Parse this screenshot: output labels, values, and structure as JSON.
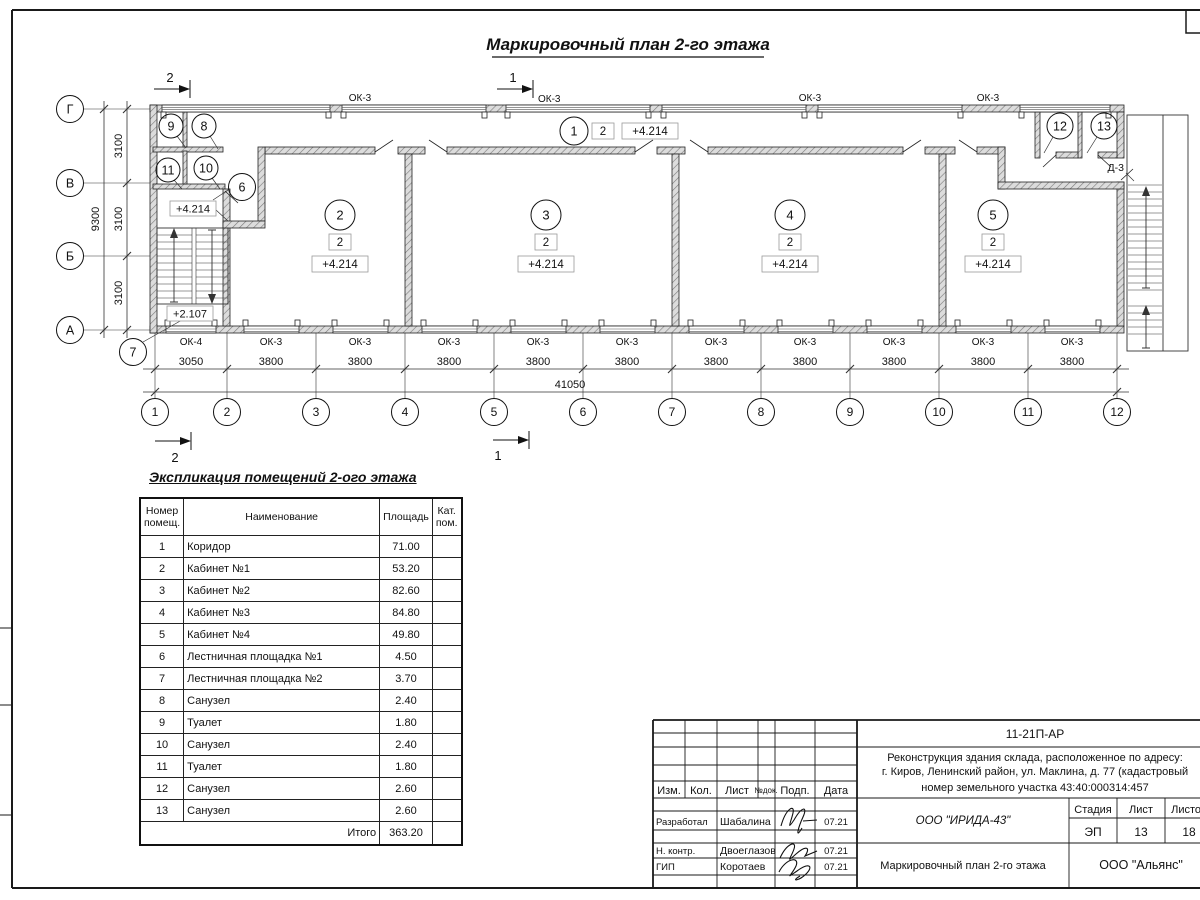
{
  "sheet": {
    "title": "Маркировочный план 2-го этажа"
  },
  "plan": {
    "section_mark_1": "1",
    "section_mark_2": "2",
    "axes_bottom": [
      "1",
      "2",
      "3",
      "4",
      "5",
      "6",
      "7",
      "8",
      "9",
      "10",
      "11",
      "12"
    ],
    "axes_left": [
      "Г",
      "В",
      "Б",
      "А"
    ],
    "dims_bottom": [
      "3050",
      "3800",
      "3800",
      "3800",
      "3800",
      "3800",
      "3800",
      "3800",
      "3800",
      "3800",
      "3800"
    ],
    "dim_total_bottom": "41050",
    "dims_left": [
      "3100",
      "3100",
      "3100"
    ],
    "dim_total_left": "9300",
    "window_ok3": "ОК-3",
    "window_ok4": "ОК-4",
    "door_d3": "Д-3",
    "level_main": "+4.214",
    "level_landing": "+2.107",
    "room_category": "2",
    "room_marks": [
      "1",
      "2",
      "3",
      "4",
      "5",
      "6",
      "7",
      "8",
      "9",
      "10",
      "11",
      "12",
      "13"
    ]
  },
  "explication": {
    "title": "Экспликация помещений 2-ого этажа",
    "col_num": "Номер помещ.",
    "col_name": "Наименование",
    "col_area": "Площадь",
    "col_cat": "Кат. пом.",
    "rows": [
      {
        "num": "1",
        "name": "Коридор",
        "area": "71.00"
      },
      {
        "num": "2",
        "name": "Кабинет №1",
        "area": "53.20"
      },
      {
        "num": "3",
        "name": "Кабинет №2",
        "area": "82.60"
      },
      {
        "num": "4",
        "name": "Кабинет №3",
        "area": "84.80"
      },
      {
        "num": "5",
        "name": "Кабинет №4",
        "area": "49.80"
      },
      {
        "num": "6",
        "name": "Лестничная площадка №1",
        "area": "4.50"
      },
      {
        "num": "7",
        "name": "Лестничная площадка №2",
        "area": "3.70"
      },
      {
        "num": "8",
        "name": "Санузел",
        "area": "2.40"
      },
      {
        "num": "9",
        "name": "Туалет",
        "area": "1.80"
      },
      {
        "num": "10",
        "name": "Санузел",
        "area": "2.40"
      },
      {
        "num": "11",
        "name": "Туалет",
        "area": "1.80"
      },
      {
        "num": "12",
        "name": "Санузел",
        "area": "2.60"
      },
      {
        "num": "13",
        "name": "Санузел",
        "area": "2.60"
      }
    ],
    "total_label": "Итого",
    "total_area": "363.20"
  },
  "titleblock": {
    "doc_number": "11-21П-АР",
    "project_line1": "Реконструкция здания склада, расположенное по адресу:",
    "project_line2": "г. Киров, Ленинский район, ул. Маклина, д. 77 (кадастровый",
    "project_line3": "номер земельного участка 43:40:000314:457",
    "col_izm": "Изм.",
    "col_kol": "Кол.",
    "col_list": "Лист",
    "col_doc": "№док.",
    "col_podp": "Подп.",
    "col_data": "Дата",
    "role_developer": "Разработал",
    "name_developer": "Шабалина",
    "date_developer": "07.21",
    "role_ncontr": "Н. контр.",
    "name_ncontr": "Двоеглазов",
    "date_ncontr": "07.21",
    "role_gip": "ГИП",
    "name_gip": "Коротаев",
    "date_gip": "07.21",
    "org_design": "ООО \"ИРИДА-43\"",
    "stage_label": "Стадия",
    "sheet_label": "Лист",
    "sheets_label": "Листов",
    "stage_value": "ЭП",
    "sheet_value": "13",
    "sheets_value": "18",
    "drawing_name": "Маркировочный план 2-го этажа",
    "org_customer": "ООО \"Альянс\""
  }
}
